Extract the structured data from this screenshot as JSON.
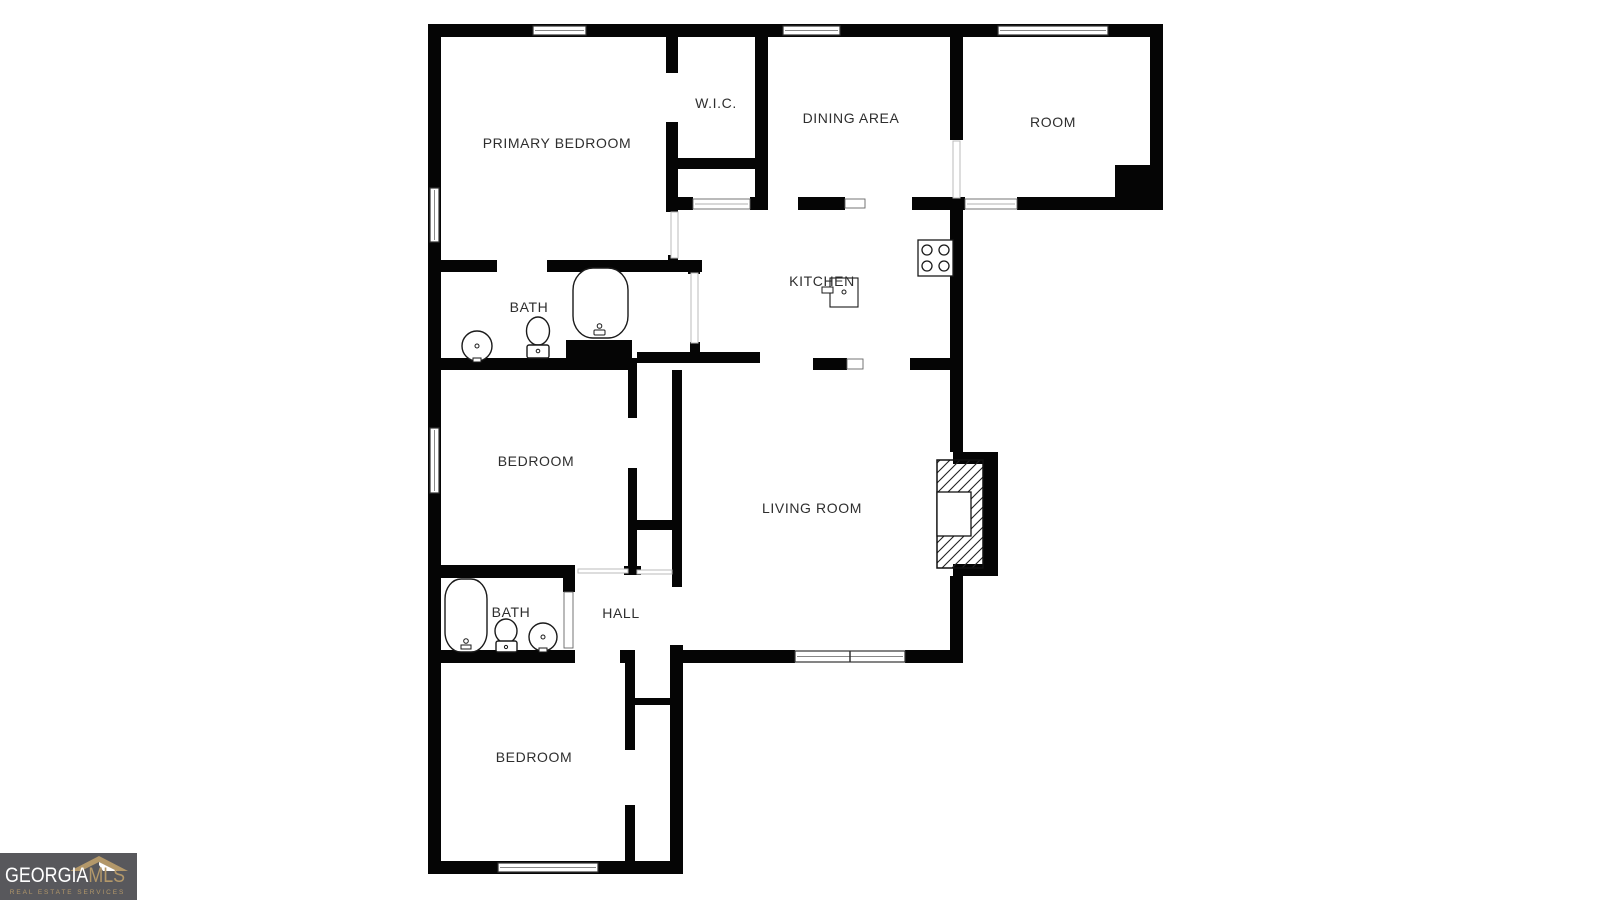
{
  "rooms": [
    {
      "id": "primary-bedroom",
      "label": "PRIMARY BEDROOM"
    },
    {
      "id": "wic",
      "label": "W.I.C."
    },
    {
      "id": "dining-area",
      "label": "DINING AREA"
    },
    {
      "id": "room",
      "label": "ROOM"
    },
    {
      "id": "bath-primary",
      "label": "BATH"
    },
    {
      "id": "kitchen",
      "label": "KITCHEN"
    },
    {
      "id": "bedroom-middle",
      "label": "BEDROOM"
    },
    {
      "id": "living-room",
      "label": "LIVING ROOM"
    },
    {
      "id": "bath-hall",
      "label": "BATH"
    },
    {
      "id": "hall",
      "label": "HALL"
    },
    {
      "id": "bedroom-bottom",
      "label": "BEDROOM"
    }
  ],
  "fixtures": [
    "bathtub",
    "toilet",
    "sink",
    "stove",
    "kitchen-sink",
    "fireplace",
    "chimney-block"
  ],
  "logo": {
    "brand_primary": "GEORGIA",
    "brand_secondary": "MLS",
    "tagline": "REAL ESTATE SERVICES",
    "background": "#58585c",
    "primary_color": "#ffffff",
    "secondary_color": "#b3986a"
  },
  "colors": {
    "background": "#ffffff",
    "wall": "#050505",
    "label_text": "#2e2e2e"
  }
}
